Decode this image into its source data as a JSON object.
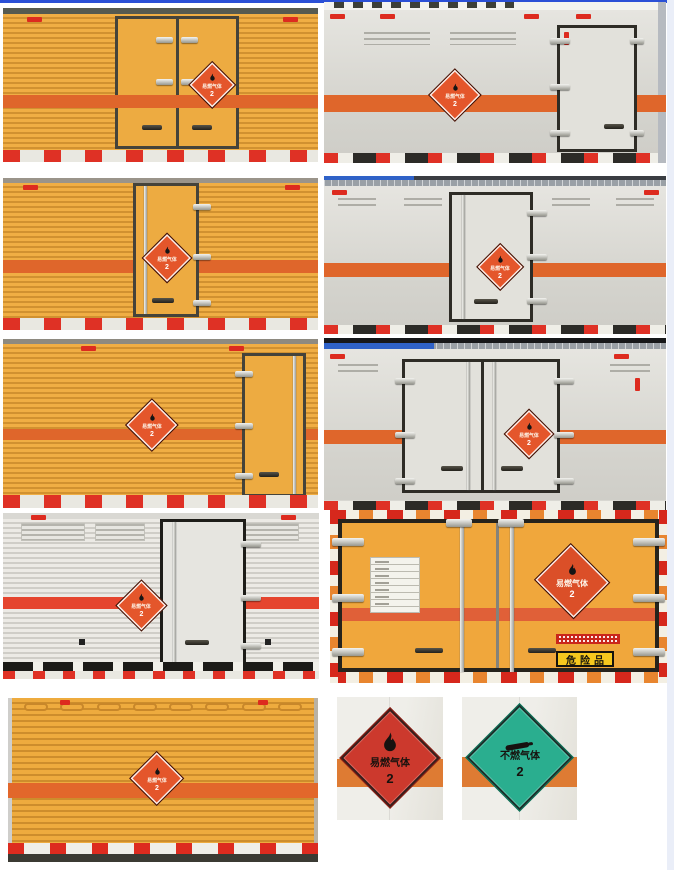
{
  "page": {
    "top_line_color": "#2b50d6",
    "right_strip_color": "#eaeef8",
    "background": "#ffffff"
  },
  "colors": {
    "truck_yellow": "#eca63c",
    "stripe_orange": "#df662b",
    "stripe_red": "#e5452e",
    "placard_orange": "#e4562b",
    "placard_red": "#cc392d",
    "placard_green": "#2aae8f",
    "reflector_red": "#dd2b1f",
    "white_truck_body": "#dcdbd5",
    "danger_sign_yellow": "#f6c71e"
  },
  "placards": {
    "flammable": {
      "label": "易燃气体",
      "class_no": "2"
    },
    "non_flammable": {
      "label": "不燃气体",
      "class_no": "2"
    }
  },
  "signs": {
    "danger_goods": "危险品"
  },
  "photos": [
    {
      "name": "yellow-box-truck-rear-double-doors"
    },
    {
      "name": "white-box-truck-rear-right-door"
    },
    {
      "name": "yellow-box-truck-rear-single-door"
    },
    {
      "name": "white-box-truck-rear-single-door"
    },
    {
      "name": "yellow-box-truck-rear-right-door"
    },
    {
      "name": "white-box-truck-rear-double-doors"
    },
    {
      "name": "silver-box-truck-rear-single-door"
    },
    {
      "name": "yellow-truck-rear-closeup-danger-sign"
    },
    {
      "name": "yellow-box-truck-side-wall"
    },
    {
      "name": "flammable-gas-placard-photo"
    },
    {
      "name": "non-flammable-gas-placard-photo"
    }
  ]
}
